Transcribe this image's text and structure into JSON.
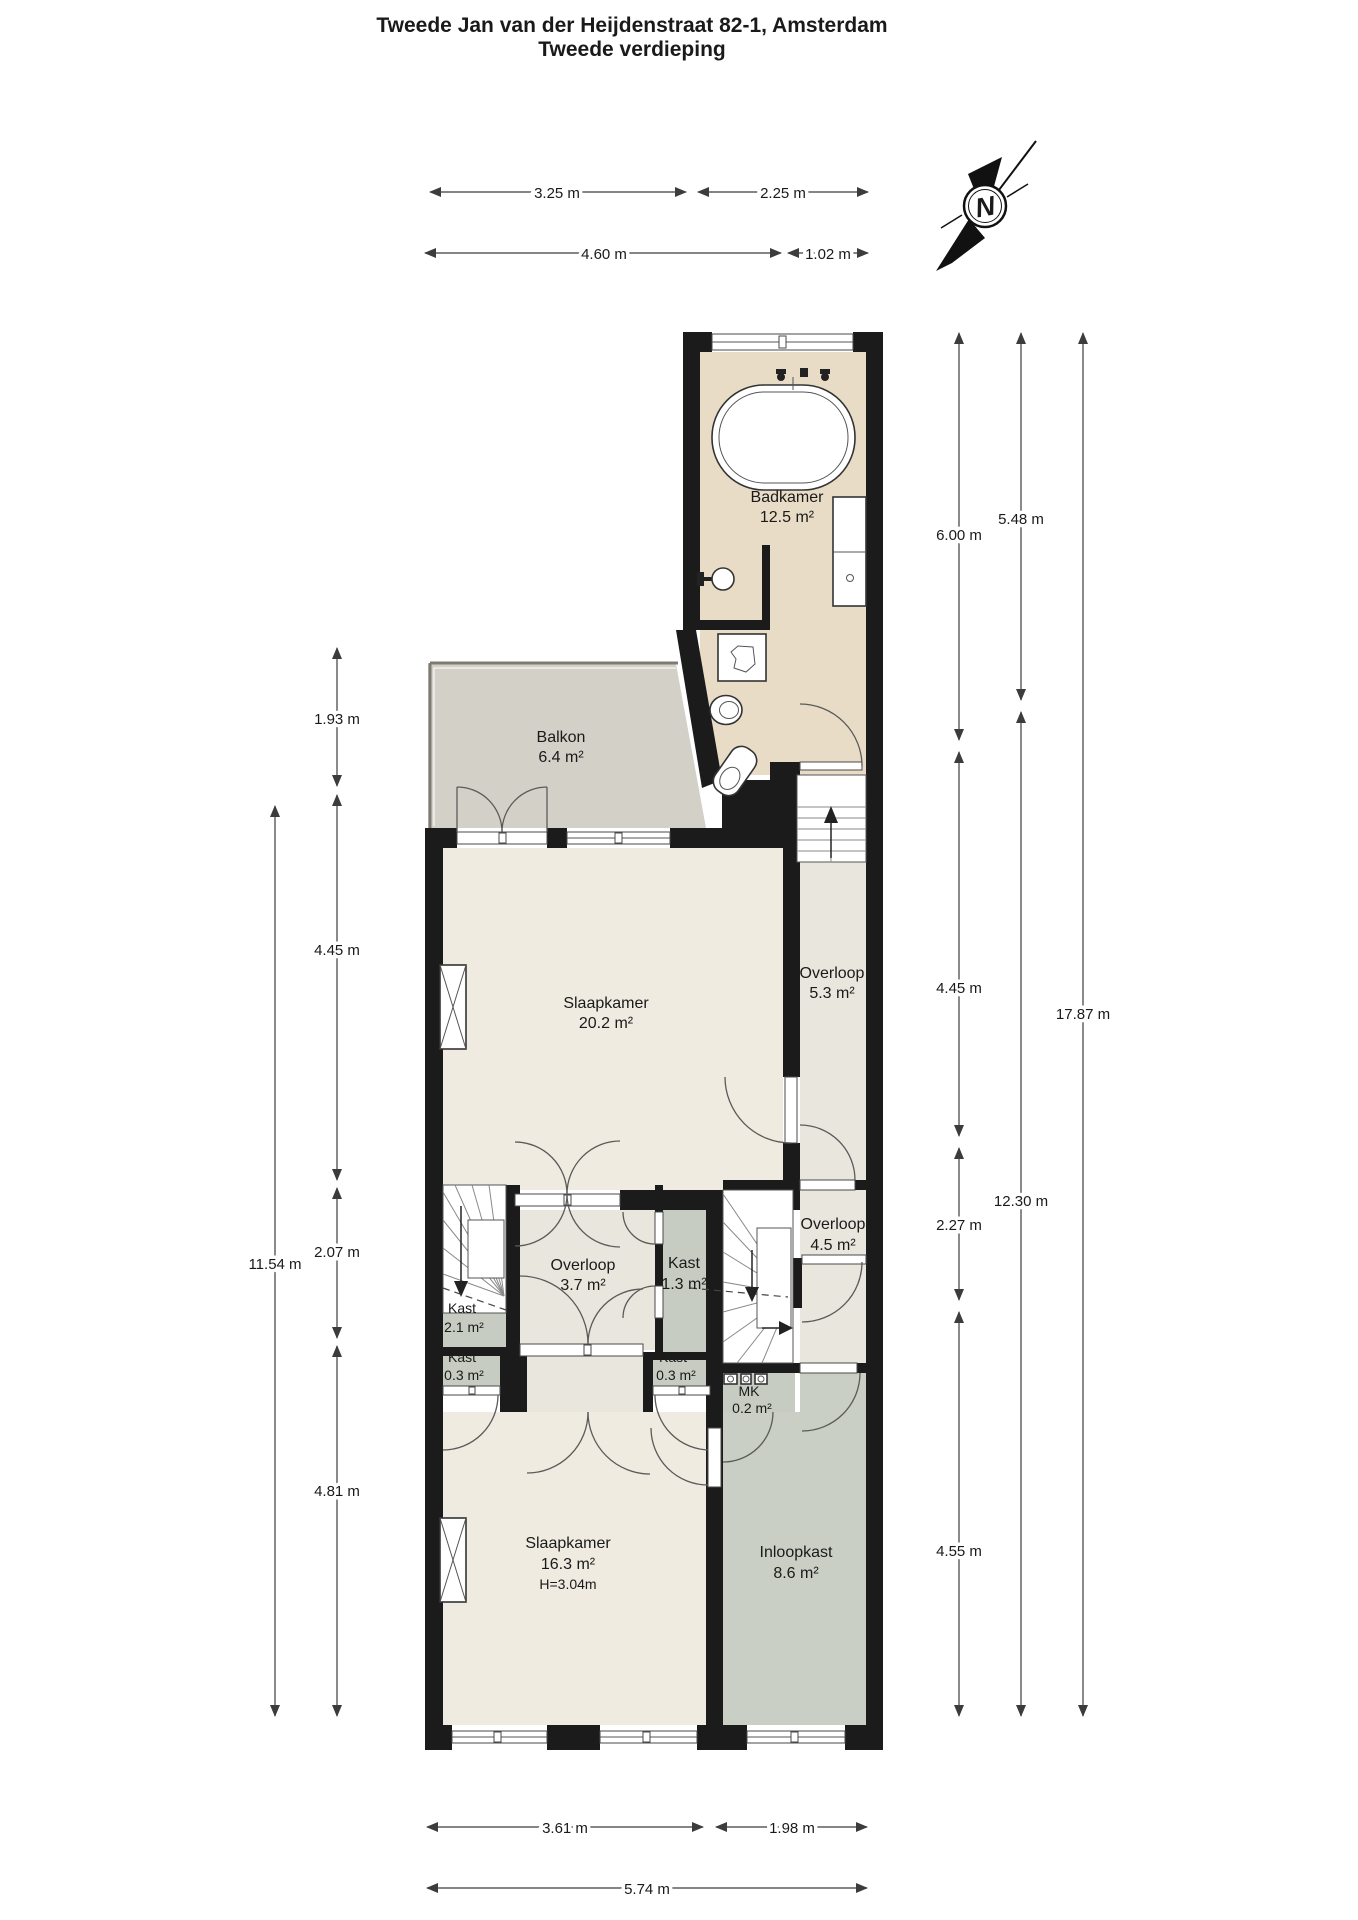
{
  "title": {
    "line1": "Tweede Jan van der Heijdenstraat 82-1, Amsterdam",
    "line2": "Tweede verdieping"
  },
  "compass": {
    "north_label": "N"
  },
  "rooms": {
    "badkamer": {
      "name": "Badkamer",
      "area": "12.5 m²"
    },
    "balkon": {
      "name": "Balkon",
      "area": "6.4 m²"
    },
    "slaapkamer_groot": {
      "name": "Slaapkamer",
      "area": "20.2 m²"
    },
    "overloop_boven": {
      "name": "Overloop",
      "area": "5.3 m²"
    },
    "overloop_midden": {
      "name": "Overloop",
      "area": "3.7 m²"
    },
    "kast_21": {
      "name": "Kast",
      "area": "2.1 m²"
    },
    "kast_13": {
      "name": "Kast",
      "area": "1.3 m²"
    },
    "kast_03_links": {
      "name": "Kast",
      "area": "0.3 m²"
    },
    "kast_03_rechts": {
      "name": "Kast",
      "area": "0.3 m²"
    },
    "overloop_45": {
      "name": "Overloop",
      "area": "4.5 m²"
    },
    "mk": {
      "name": "MK",
      "area": "0.2 m²"
    },
    "slaapkamer_klein": {
      "name": "Slaapkamer",
      "area": "16.3 m²",
      "height": "H=3.04m"
    },
    "inloopkast": {
      "name": "Inloopkast",
      "area": "8.6 m²"
    }
  },
  "dims": {
    "top": [
      "3.25 m",
      "2.25 m",
      "4.60 m",
      "1.02 m"
    ],
    "left": [
      "1.93 m",
      "4.45 m",
      "2.07 m",
      "4.81 m",
      "11.54 m"
    ],
    "right": [
      "6.00 m",
      "4.45 m",
      "2.27 m",
      "4.55 m",
      "5.48 m",
      "12.30 m",
      "17.87 m"
    ],
    "bottom": [
      "3.61 m",
      "1.98 m",
      "5.74 m"
    ]
  },
  "colors": {
    "wall": "#1b1b1b",
    "badkamer_floor": "#e8dcc6",
    "balkon_floor": "#d3d0c8",
    "room_floor": "#efebe0",
    "hal_floor": "#e9e6dd",
    "kast_floor": "#c7ccc2",
    "inloopkast_floor": "#c9cfc5",
    "dimension_lines": "#3c3c3c"
  }
}
